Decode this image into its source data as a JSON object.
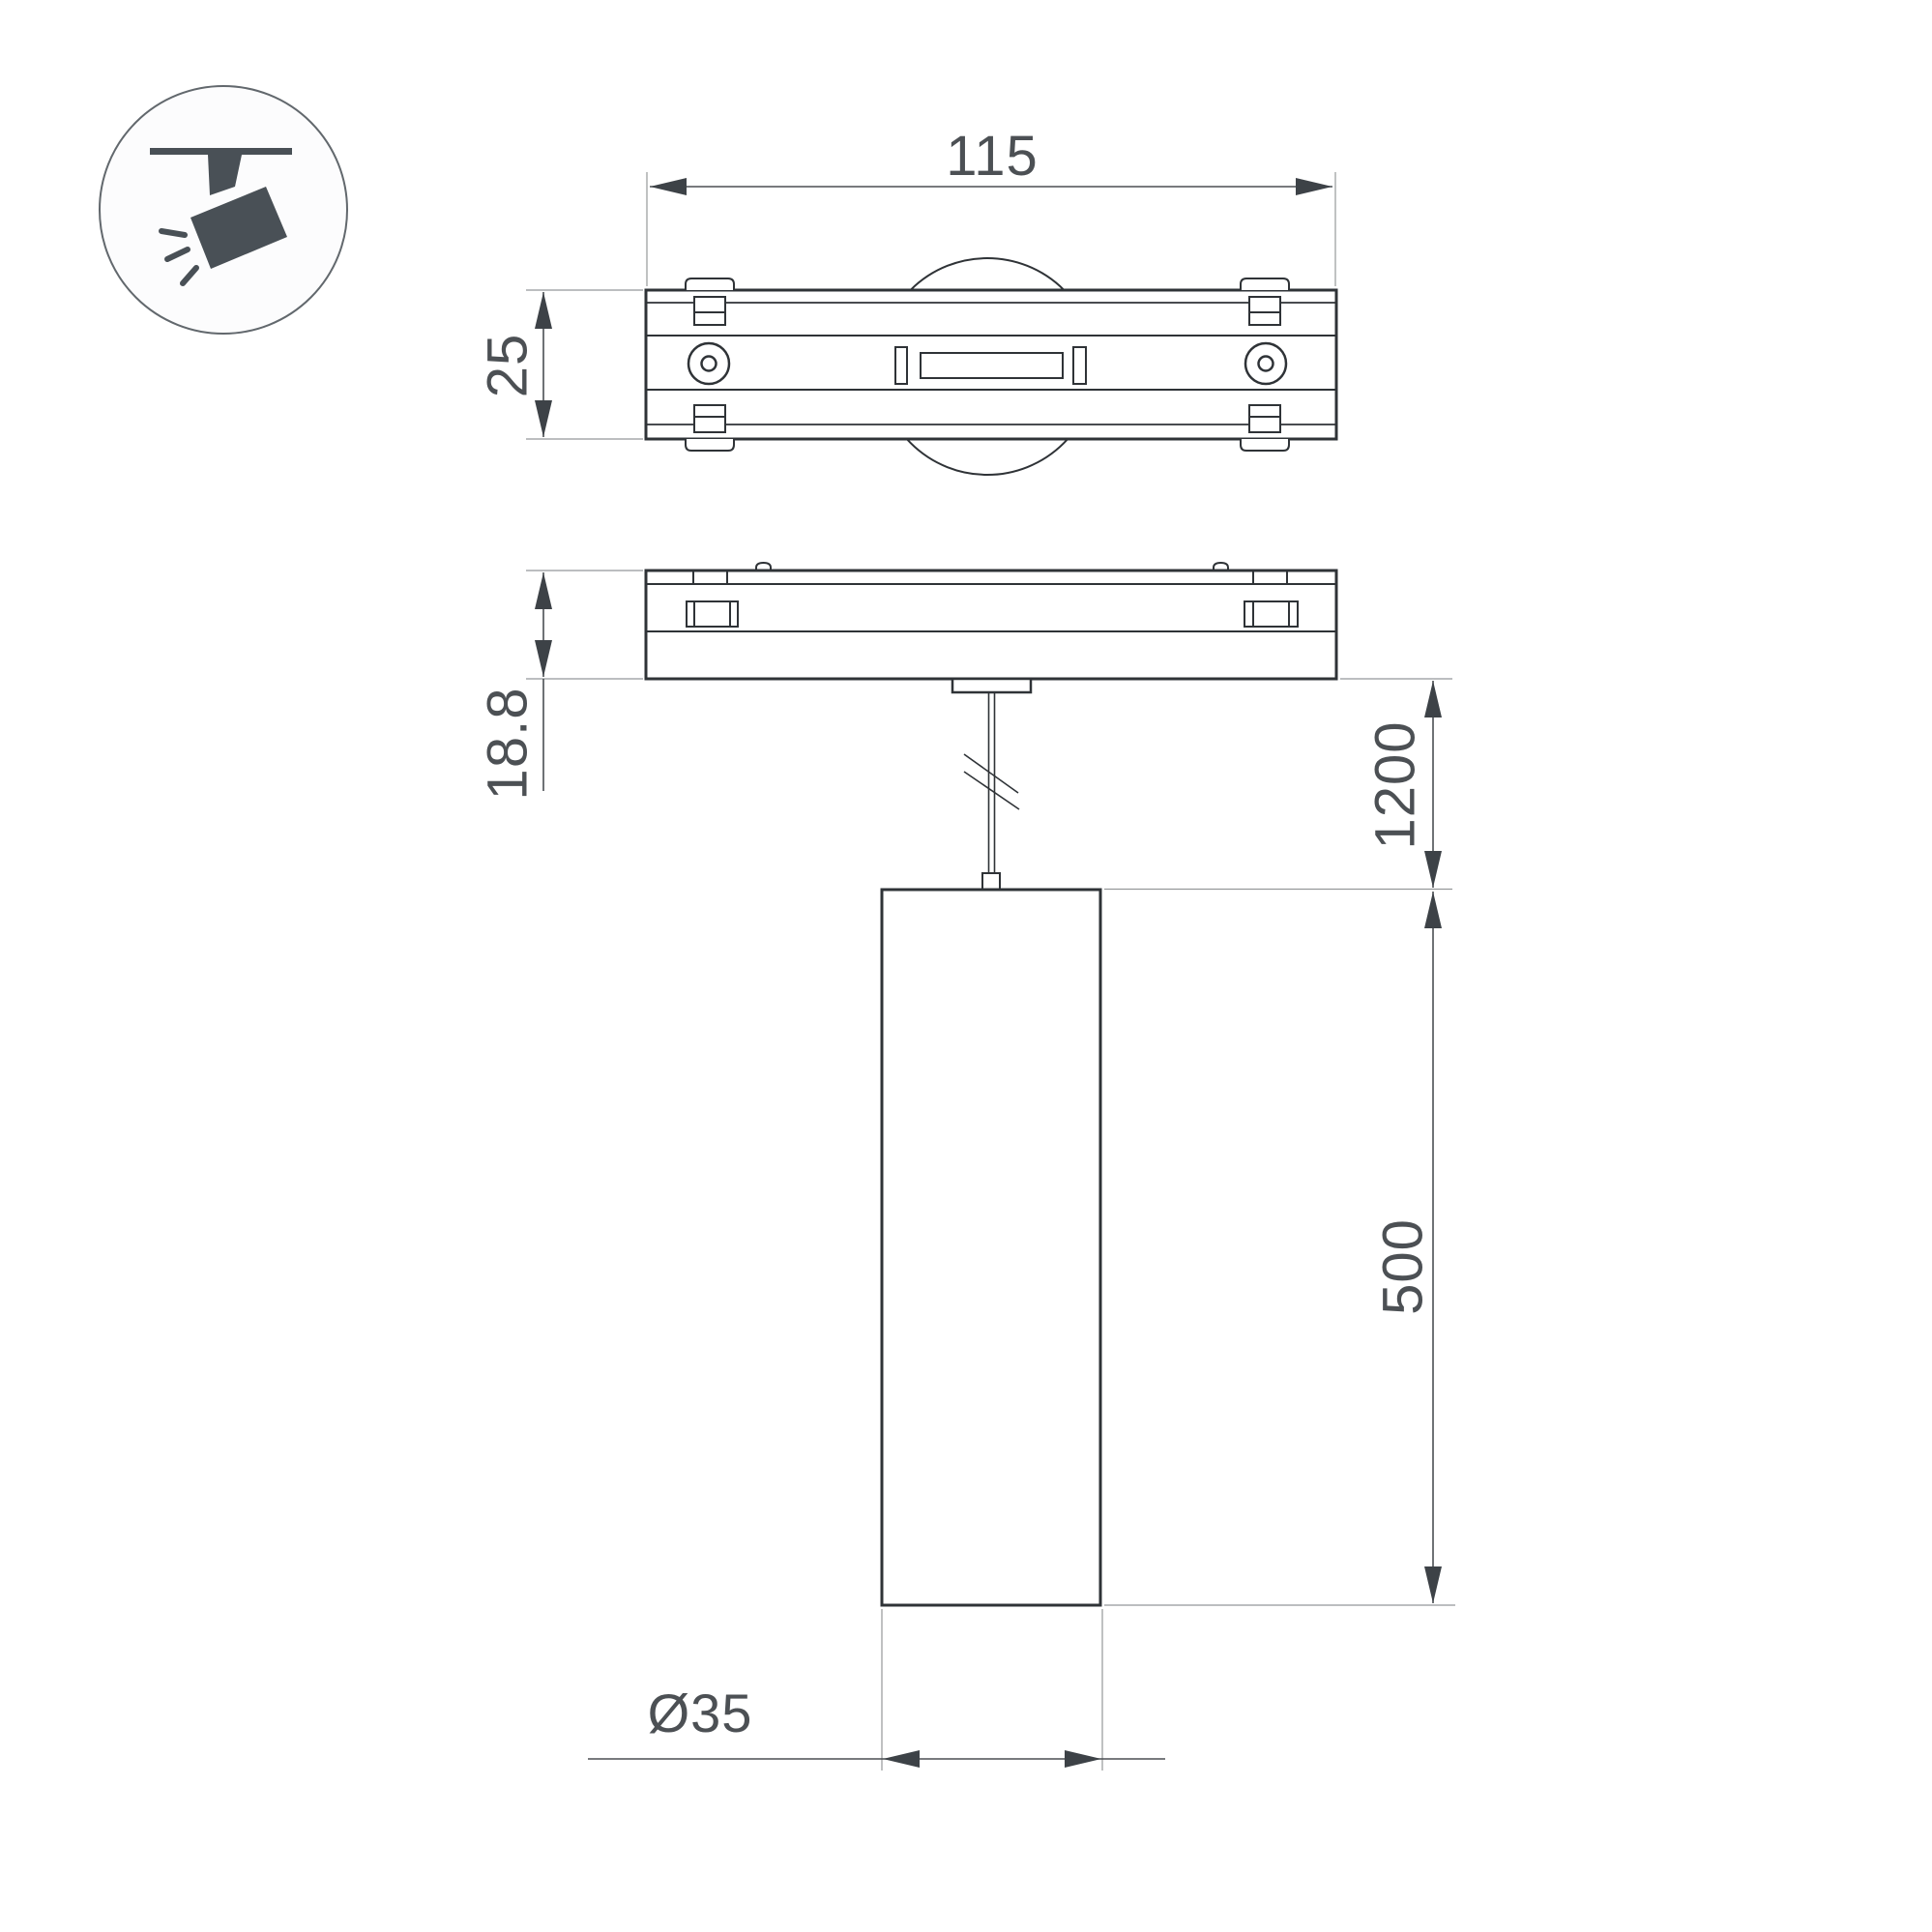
{
  "colors": {
    "background": "#ffffff",
    "outline": "#2f3337",
    "dimension_line": "#4b4f53",
    "extension_line": "#95989a",
    "text": "#4c5054",
    "icon": "#495056",
    "icon_circle_stroke": "#62686d"
  },
  "icon": {
    "name": "track-spotlight-icon"
  },
  "dimensions": {
    "top_width": "115",
    "top_depth": "25",
    "adapter_height": "18.8",
    "suspension": "1200",
    "pendant_length": "500",
    "diameter": "Ø35"
  }
}
